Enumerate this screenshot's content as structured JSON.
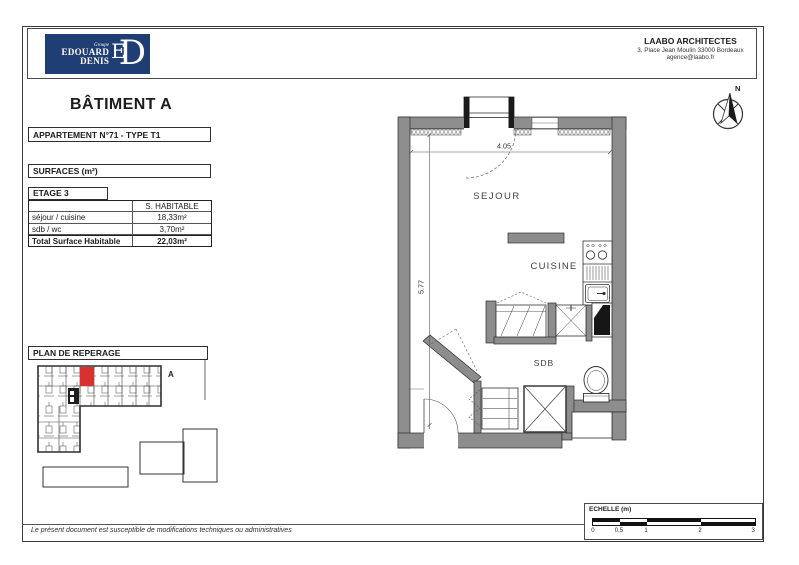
{
  "header": {
    "logo": {
      "groupe": "Groupe",
      "edouard": "EDOUARD",
      "denis": "DENIS",
      "monogram_e": "E",
      "monogram_d": "D",
      "bg_color": "#1f3e73"
    },
    "architect": {
      "name": "LAABO ARCHITECTES",
      "address": "3, Place Jean Moulin 33000 Bordeaux",
      "email": "agence@laabo.fr"
    }
  },
  "compass": {
    "north_label": "N"
  },
  "title": "BÂTIMENT A",
  "apartment_label": "APPARTEMENT N°71 - TYPE T1",
  "surfaces": {
    "box_label": "SURFACES (m²)",
    "etage_label": "ETAGE 3",
    "column_header": "S. HABITABLE",
    "rows": [
      {
        "label": "séjour / cuisine",
        "value": "18,33m²"
      },
      {
        "label": "sdb / wc",
        "value": "3,70m²"
      }
    ],
    "total": {
      "label": "Total Surface Habitable",
      "value": "22,03m²"
    }
  },
  "floorplan": {
    "rooms": {
      "sejour": "SEJOUR",
      "cuisine": "CUISINE",
      "sdb": "SDB"
    },
    "dimensions": {
      "width_m": "4.05",
      "height_m": "5.77"
    },
    "wall_color": "#8d8d8d"
  },
  "reperage": {
    "title": "PLAN DE REPERAGE",
    "building_label": "A",
    "highlight_color": "#db3030"
  },
  "scale": {
    "label": "ECHELLE (m)",
    "ticks": [
      "0",
      "0,5",
      "1",
      "2",
      "3"
    ]
  },
  "footer": {
    "note": "Le présent document est susceptible de modifications techniques ou administratives"
  }
}
